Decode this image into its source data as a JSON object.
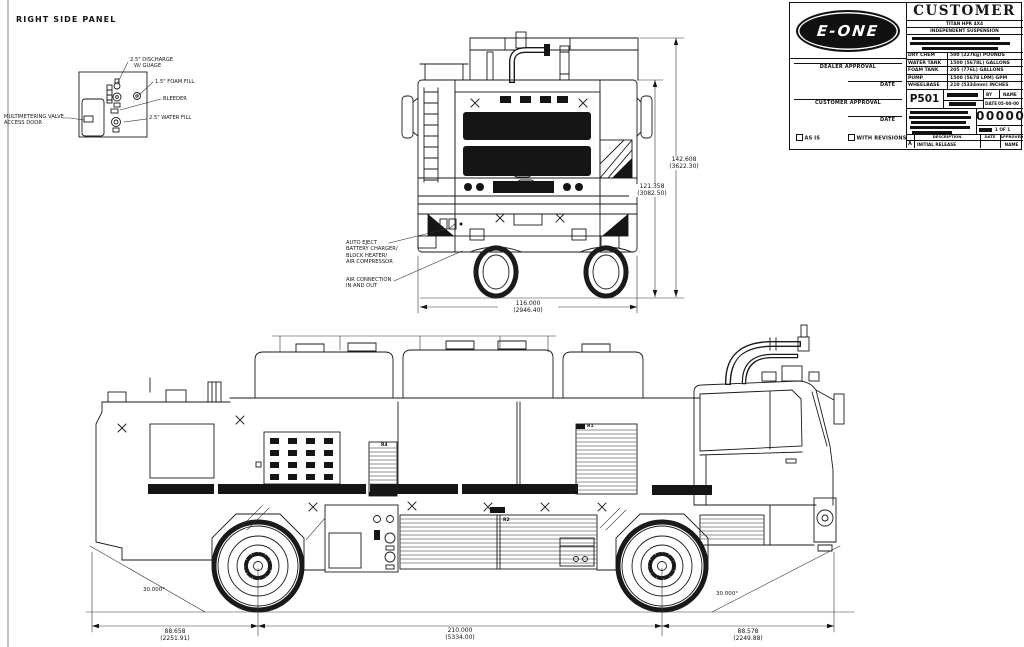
{
  "panel_detail": {
    "title": "RIGHT SIDE PANEL",
    "discharge_line1": "2.5\" DISCHARGE",
    "discharge_line2": "W/ GUAGE",
    "foam_fill": "1.5\" FOAM FILL",
    "bleeder": "BLEEDER",
    "water_fill": "2.5\" WATER FILL",
    "multimetering_line1": "MULTIMETERING VALVE",
    "multimetering_line2": "ACCESS DOOR"
  },
  "rear_view": {
    "auto_eject_lines": [
      "AUTO EJECT",
      "BATTERY CHARGER/",
      "BLOCK HEATER/",
      "AIR COMPRESSOR"
    ],
    "air_connection_lines": [
      "AIR CONNECTION",
      "IN AND OUT"
    ],
    "dim_overall_height_in": "142.608",
    "dim_overall_height_mm": "(3622.30)",
    "dim_body_height_in": "121.358",
    "dim_body_height_mm": "(3082.50)",
    "dim_width_in": "116.000",
    "dim_width_mm": "(2946.40)"
  },
  "side_view": {
    "label_r1": "R1",
    "label_r2": "R2",
    "label_r4": "R4",
    "angle_rear": "30.000°",
    "angle_front": "30.000°",
    "dim_rear_overhang_in": "88.658",
    "dim_rear_overhang_mm": "(2251.91)",
    "dim_wheelbase_in": "210.000",
    "dim_wheelbase_mm": "(5334.00)",
    "dim_front_overhang_in": "88.578",
    "dim_front_overhang_mm": "(2249.88)"
  },
  "title_block": {
    "logo_text": "E-ONE",
    "customer_heading": "CUSTOMER",
    "model": "TITAN HPR 4X4",
    "suspension": "INDEPENDENT SUSPENSION",
    "specs": [
      {
        "label": "DRY CHEM",
        "value": "500 (227kg) POUNDS"
      },
      {
        "label": "WATER TANK",
        "value": "1500 (5678L) GALLONS"
      },
      {
        "label": "FOAM TANK",
        "value": "205 (776L) GALLONS"
      },
      {
        "label": "PUMP",
        "value": "1500 (5678 LPM) GPM"
      },
      {
        "label": "WHEELBASE",
        "value": "210 (5334mm) INCHES"
      }
    ],
    "dealer_approval_label": "DEALER APPROVAL",
    "customer_approval_label": "CUSTOMER APPROVAL",
    "date_label": "DATE",
    "as_is_label": "AS IS",
    "with_revisions_label": "WITH REVISIONS",
    "part_code": "P501",
    "by_label": "BY",
    "name_label": "NAME",
    "date_field_label": "DATE",
    "date_value": "05-00-00",
    "drawing_number": "00000",
    "sheet_label": "1 OF 1",
    "rev_description_header": "DESCRIPTION",
    "rev_date_header": "DATE",
    "rev_approved_header": "APPROVED",
    "rev_letter": "A",
    "rev_description": "INITIAL RELEASE",
    "rev_name": "NAME"
  }
}
